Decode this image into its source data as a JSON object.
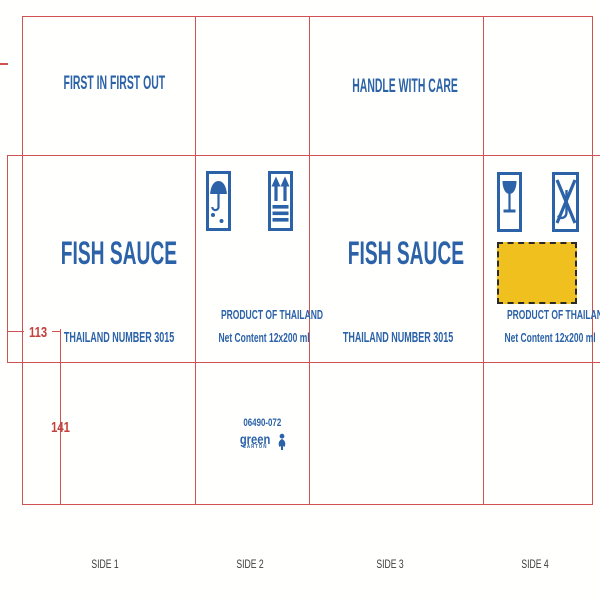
{
  "document": {
    "type": "carton dieline scan",
    "product": "FISH SAUCE"
  },
  "colors": {
    "print_blue": "#2b62a8",
    "dieline_red": "#d05252",
    "label_yellow": "#f0c11e",
    "side_label_gray": "#3c3c3c"
  },
  "top_flaps": {
    "flap1_text": "FIRST IN FIRST OUT",
    "flap3_text": "HANDLE WITH CARE"
  },
  "sides": {
    "side1": {
      "title": "FISH SAUCE",
      "subtitle": "THAILAND NUMBER 3015"
    },
    "side2": {
      "icon1": "keep-dry-umbrella",
      "icon2": "this-way-up-arrows",
      "product_line": "PRODUCT OF THAILAND",
      "net_content_line": "Net Content 12x200 ml"
    },
    "side3": {
      "title": "FISH SAUCE",
      "subtitle": "THAILAND NUMBER 3015"
    },
    "side4": {
      "icon1": "fragile-glass",
      "icon2": "no-hand-hooks",
      "product_line": "PRODUCT OF THAILAND",
      "net_content_line": "Net Content 12x200 ml"
    }
  },
  "dimensions": {
    "panel_height_mm": "113",
    "flap_width_mm": "141"
  },
  "print_info": {
    "job_code": "06490-072",
    "logo_text": "green",
    "logo_subtext": "CARTON"
  },
  "side_labels": [
    "SIDE 1",
    "SIDE 2",
    "SIDE 3",
    "SIDE 4"
  ]
}
